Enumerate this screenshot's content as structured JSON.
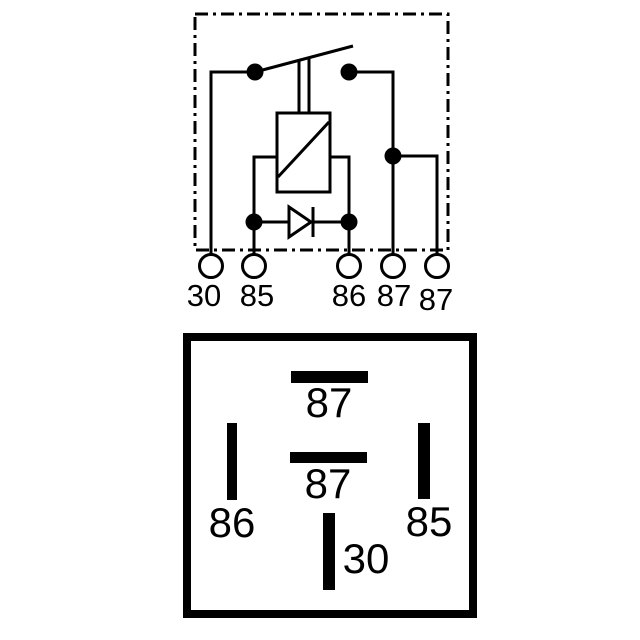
{
  "colors": {
    "ink": "#000000",
    "background": "#ffffff"
  },
  "schematic": {
    "terminals": [
      {
        "label": "30"
      },
      {
        "label": "85"
      },
      {
        "label": "86"
      },
      {
        "label": "87"
      },
      {
        "label": "87"
      }
    ]
  },
  "pin_layout": {
    "pins": [
      {
        "label": "87",
        "position": "top"
      },
      {
        "label": "87",
        "position": "middle"
      },
      {
        "label": "86",
        "position": "left"
      },
      {
        "label": "85",
        "position": "right"
      },
      {
        "label": "30",
        "position": "bottom"
      }
    ]
  }
}
